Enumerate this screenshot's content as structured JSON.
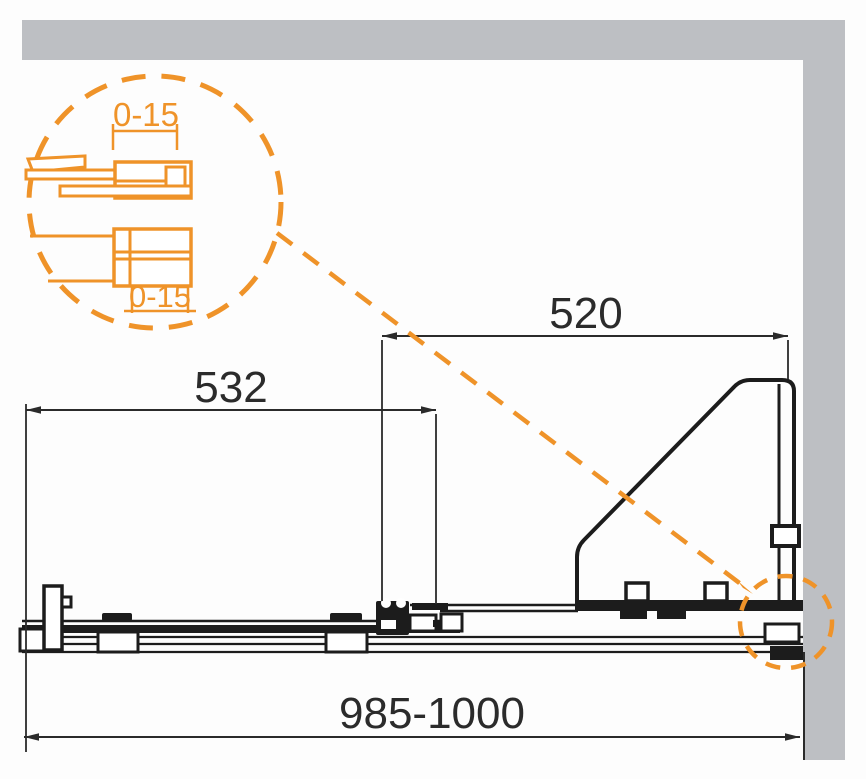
{
  "diagram": {
    "title": "shower-door-profile-technical-drawing",
    "dimensions": {
      "door": "532",
      "fixed_panel": "520",
      "overall": "985-1000"
    },
    "detail": {
      "upper": "0-15",
      "lower": "0-15"
    },
    "colors": {
      "accent": "#EF9329",
      "line": "#1C1C1C",
      "dim": "#2B2B2B",
      "wall": "#BDBFC3"
    }
  }
}
